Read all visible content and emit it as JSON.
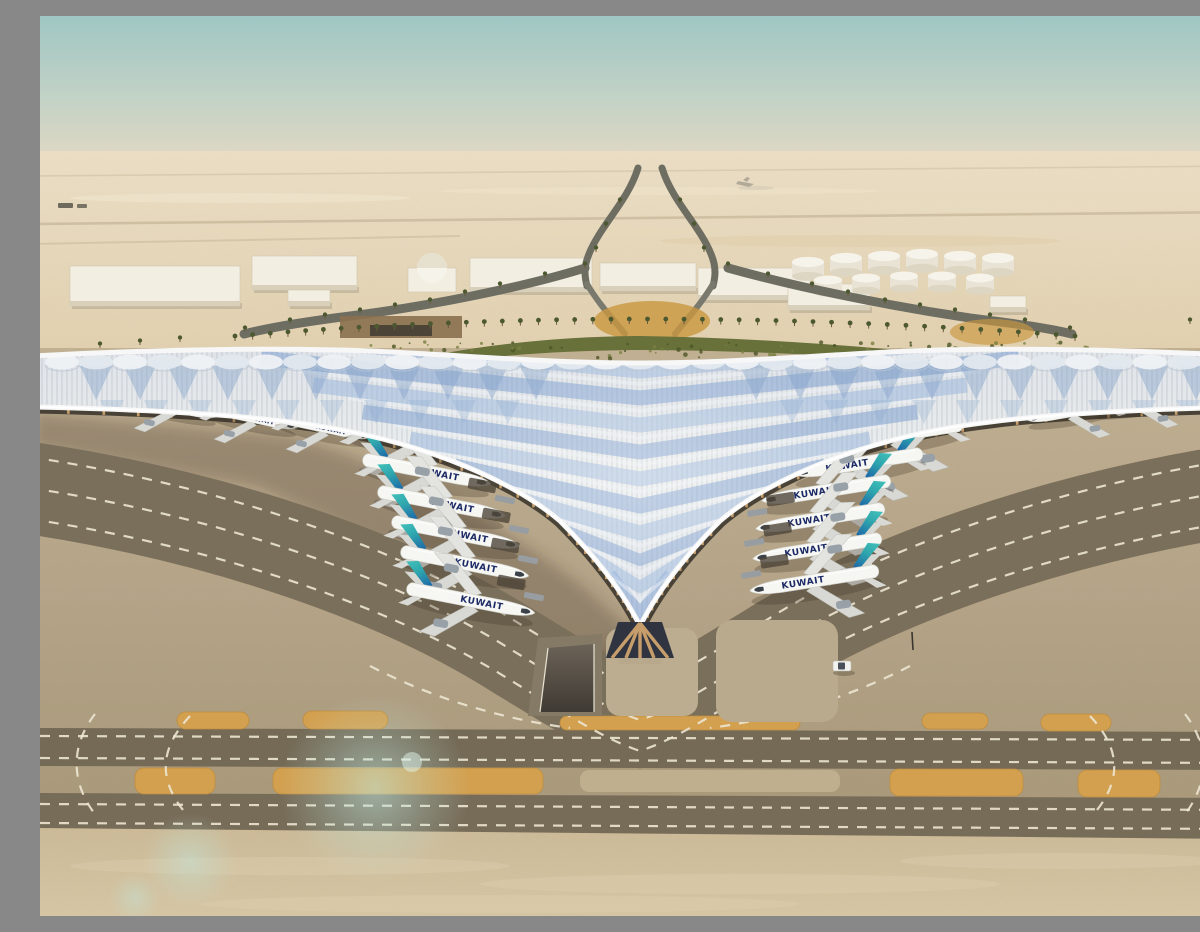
{
  "scene": {
    "description": "Aerial architectural rendering of Kuwait International Airport new passenger terminal: a vast trefoil winged roof of silver-blue ribbed panels, Kuwait Airways jets parked nose-in at both wings, desert landscape, palm-lined approach roads, fuel tank farm, and taxiways with dashed white markings in the foreground."
  },
  "airline": {
    "label": "KUWAIT",
    "title_color": "#1c2a66",
    "tail_teal": "#45c4bb",
    "tail_mid": "#2fa7ae",
    "tail_blue": "#1b62a8"
  },
  "aircraft": {
    "gates_left": [
      [
        374,
        424
      ],
      [
        389,
        456
      ],
      [
        404,
        488
      ],
      [
        418,
        518
      ],
      [
        427,
        548
      ],
      [
        433,
        585
      ]
    ],
    "gates_right": [
      [
        856,
        419
      ],
      [
        816,
        448
      ],
      [
        784,
        475
      ],
      [
        778,
        503
      ],
      [
        775,
        533
      ],
      [
        772,
        565
      ]
    ],
    "remote_left": [
      [
        133,
        391
      ],
      [
        213,
        402
      ],
      [
        285,
        412
      ]
    ],
    "remote_right": [
      [
        1032,
        396
      ],
      [
        1100,
        386
      ],
      [
        1164,
        377
      ]
    ]
  },
  "palette": {
    "sky_top": "#9fc7c3",
    "sky_mid": "#c3d2c6",
    "sky_horizon": "#e4d9c3",
    "desert_far": "#ecdfc6",
    "desert_mid": "#e2d1b0",
    "road_dark": "#6e6d62",
    "road_light": "#c4b394",
    "building_top": "#f2eee2",
    "building_side": "#d8d0ba",
    "palm": "#4c5830",
    "garden": "#68713a",
    "garden_dark": "#4c5627",
    "roof_light": "#e9ebea",
    "roof_mid": "#dde3e9",
    "roof_blue": "#7fa0d0",
    "roof_blue2": "#9db8dd",
    "fascia": "#f6f7f6",
    "rib": "#8795a8",
    "facade_dark": "#3f3a30",
    "column": "#c79e6b",
    "apron": "#bcab8e",
    "apron_low": "#a2937a",
    "taxi_dark": "#7a6f5a",
    "taxi_dark2": "#746a56",
    "dash": "#ece5d2",
    "orange": "#d3a050",
    "orange_dk": "#c08c3e",
    "sand_fore": "#cdbb98",
    "sand_fore2": "#d8c8a6",
    "shadow": "rgba(70,58,40,0.30)",
    "flare": "#bfe8e0",
    "fuselage": "#f6f6f3",
    "wing_grey": "#d8d8d4",
    "engine": "#98a0a8",
    "glass": "#2f3440"
  },
  "counts": {
    "gate_aircraft": 12,
    "remote_aircraft": 6,
    "fuel_tanks": 11
  }
}
